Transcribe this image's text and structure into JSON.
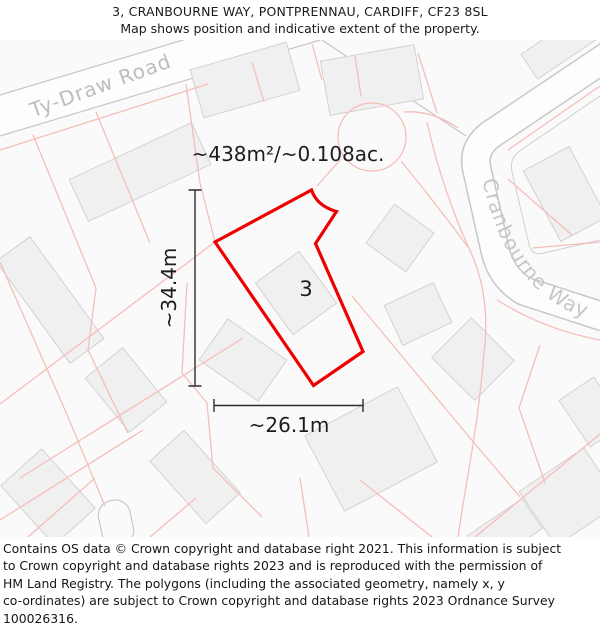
{
  "header": {
    "title": "3, CRANBOURNE WAY, PONTPRENNAU, CARDIFF, CF23 8SL",
    "subtitle": "Map shows position and indicative extent of the property."
  },
  "map": {
    "area_label": "~438m²/~0.108ac.",
    "plot_number": "3",
    "width_label": "~26.1m",
    "height_label": "~34.4m",
    "roads": {
      "ty_draw": "Ty-Draw Road",
      "cranbourne": "Cranbourne Way"
    },
    "colors": {
      "boundary": "#ee0000",
      "parcel_line": "#f5beb8",
      "building_fill": "#f1f0f0",
      "building_stroke": "#cfcfcf",
      "road_casing": "#c7c7c7",
      "road_fill": "#fdfdfd",
      "map_background": "#fbfafa",
      "road_label": "#bdbdbd",
      "dimension": "#2d2d2d",
      "text": "#1d1d1d"
    }
  },
  "footer": {
    "lines": [
      "Contains OS data © Crown copyright and database right 2021. This information is subject",
      "to Crown copyright and database rights 2023 and is reproduced with the permission of",
      "HM Land Registry. The polygons (including the associated geometry, namely x, y",
      "co-ordinates) are subject to Crown copyright and database rights 2023 Ordnance Survey",
      "100026316."
    ]
  }
}
